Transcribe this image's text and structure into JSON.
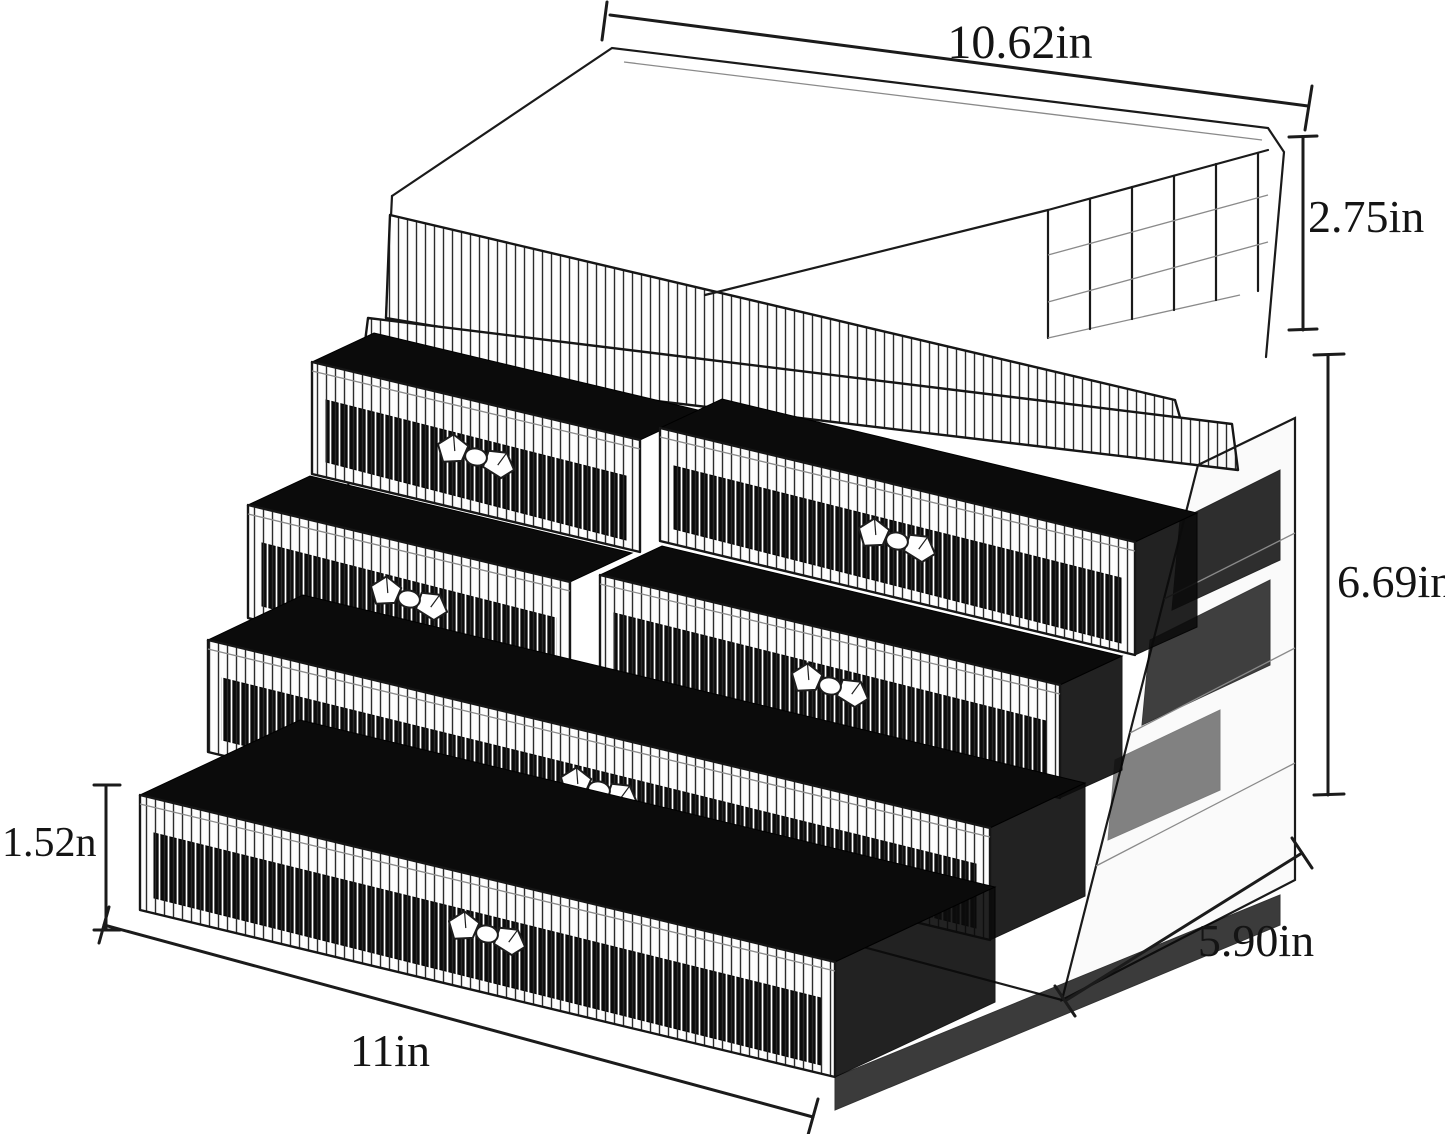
{
  "figure": {
    "description": "Clear acrylic cosmetic organizer with an open lipstick tray on top and six ribbed pull-out drawers with crystal knobs, annotated with product dimensions"
  },
  "dimensions": {
    "top_width": "10.62in",
    "top_section_height": "2.75in",
    "drawer_section_height": "6.69in",
    "single_drawer_height": "1.52n",
    "bottom_width": "11in",
    "depth": "5.90in"
  },
  "colors": {
    "background": "#ffffff",
    "line": "#1a1a1a",
    "drawer_interior": "#0b0b0b"
  }
}
